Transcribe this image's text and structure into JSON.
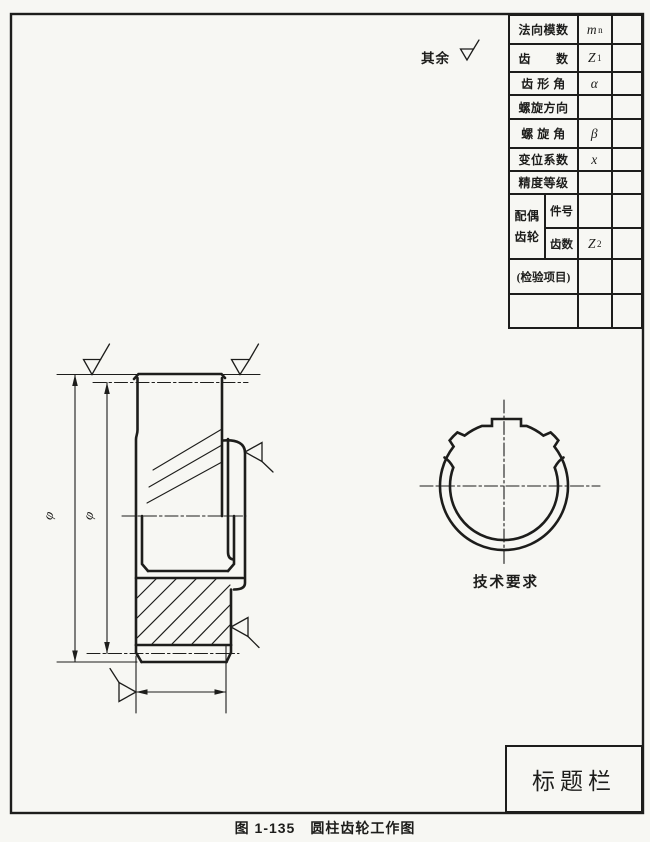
{
  "colors": {
    "paper": "#f7f7f3",
    "ink": "#1d1d1b"
  },
  "page": {
    "caption": "图 1-135　圆柱齿轮工作图",
    "rest_surfaces_note": "其余",
    "tech_requirements": "技术要求",
    "title_block_label": "标题栏",
    "dim_outer_diameter": "φ",
    "dim_pitch_diameter": "φ"
  },
  "spec_table": {
    "rows": [
      {
        "label": "法向模数",
        "sym": "m",
        "sub": "n",
        "value": ""
      },
      {
        "label": "齿　　数",
        "sym": "Z",
        "sub": "1",
        "value": ""
      },
      {
        "label": "齿 形 角",
        "sym": "α",
        "sub": "",
        "value": ""
      },
      {
        "label": "螺旋方向",
        "sym": "",
        "sub": "",
        "value": ""
      },
      {
        "label": "螺 旋 角",
        "sym": "β",
        "sub": "",
        "value": ""
      },
      {
        "label": "变位系数",
        "sym": "x",
        "sub": "",
        "value": ""
      },
      {
        "label": "精度等级",
        "sym": "",
        "sub": "",
        "value": ""
      }
    ],
    "mate_gear": {
      "label_line1": "配偶",
      "label_line2": "齿轮",
      "row1_label": "件号",
      "row1_sym": "",
      "row1_value": "",
      "row2_label": "齿数",
      "row2_sym": "Z",
      "row2_sub": "2",
      "row2_value": ""
    },
    "inspection_label": "(检验项目)"
  }
}
